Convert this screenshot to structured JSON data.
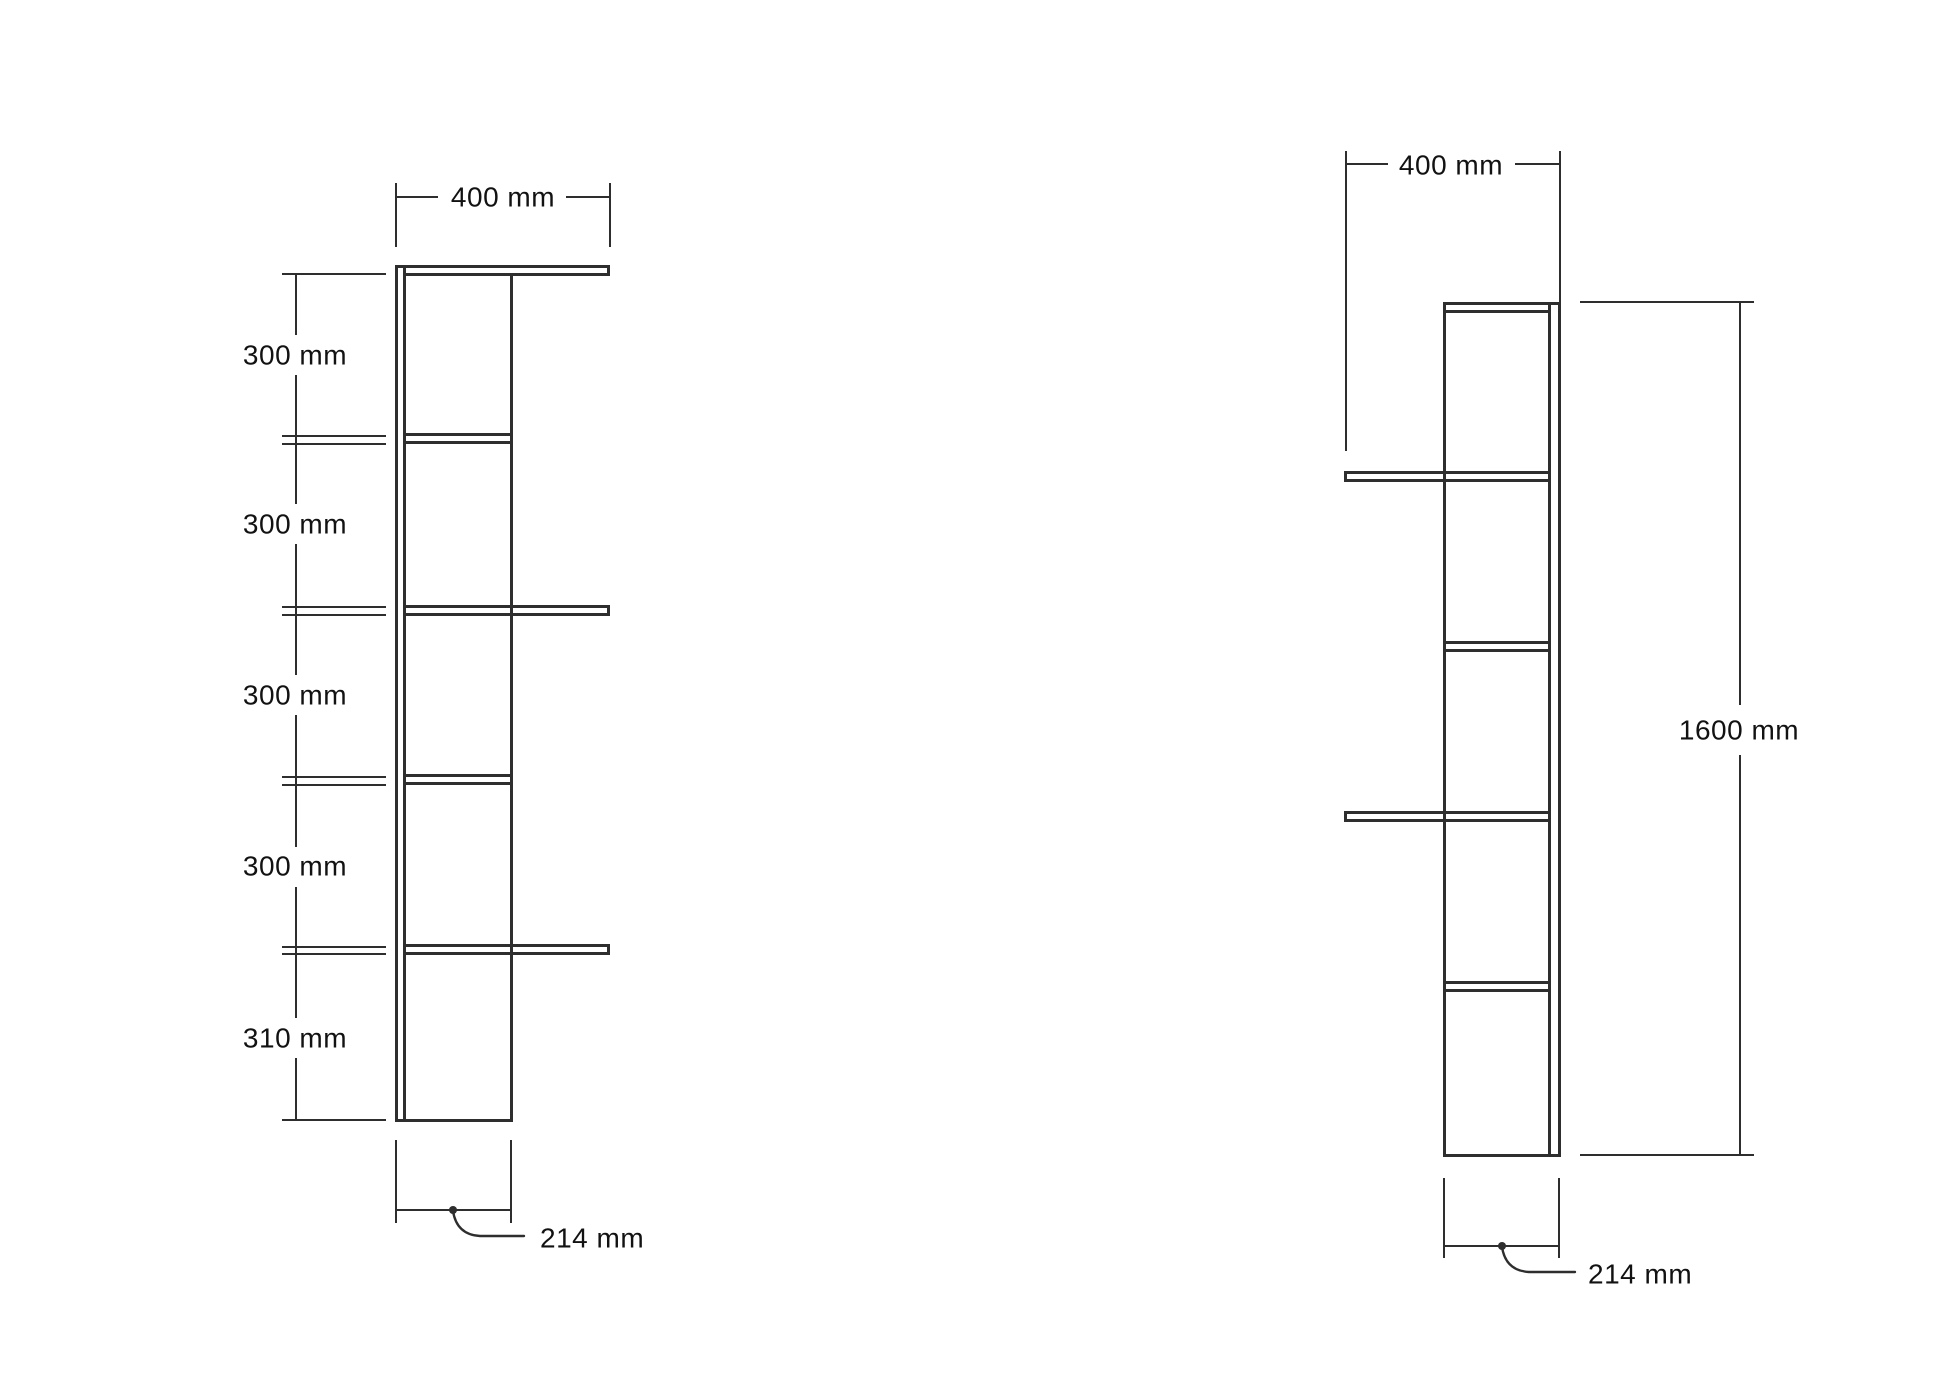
{
  "colors": {
    "line": "#2e2e2e",
    "dimension": "#2e2e2e",
    "text": "#121212",
    "background": "#ffffff"
  },
  "left_view": {
    "width_label": "400 mm",
    "section_labels": [
      "300 mm",
      "300 mm",
      "300 mm",
      "300 mm",
      "310 mm"
    ],
    "depth_label": "214 mm"
  },
  "right_view": {
    "width_label": "400 mm",
    "height_label": "1600 mm",
    "depth_label": "214 mm"
  }
}
